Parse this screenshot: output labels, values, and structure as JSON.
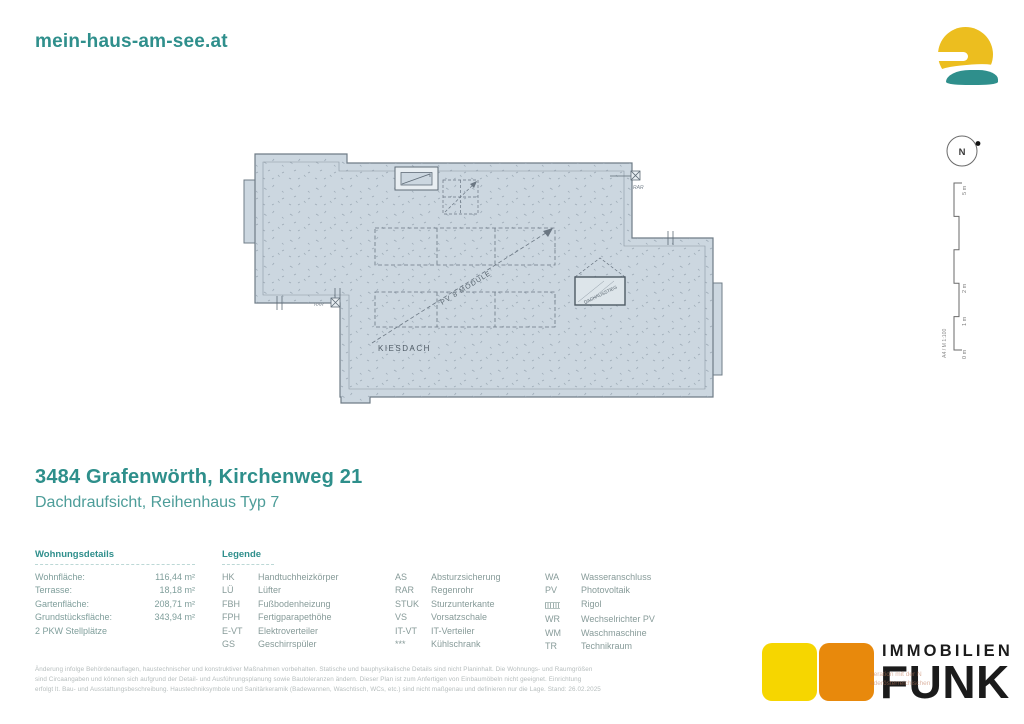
{
  "header": {
    "site_name": "mein-haus-am-see.at"
  },
  "compass": {
    "label": "N"
  },
  "scalebar": {
    "m0": "0 m",
    "m1": "1 m",
    "m2": "2 m",
    "m5": "5 m",
    "note": "A4 / M 1:100"
  },
  "plan": {
    "roof_label": "KIESDACH",
    "pv_label": "PV 8 MODULE",
    "hatch_label": "DACHAUSSTIEG",
    "rar_label_top": "RAR",
    "rar_label_bottom": "RAR"
  },
  "title": {
    "heading": "3484 Grafenwörth, Kirchenweg 21",
    "subheading": "Dachdraufsicht, Reihenhaus Typ 7"
  },
  "details": {
    "header": "Wohnungsdetails",
    "rows": [
      {
        "label": "Wohnfläche:",
        "value": "116,44 m²"
      },
      {
        "label": "Terrasse:",
        "value": "18,18 m²"
      },
      {
        "label": "Gartenfläche:",
        "value": "208,71 m²"
      },
      {
        "label": "Grundstücksfläche:",
        "value": "343,94 m²"
      }
    ],
    "extra": "2 PKW Stellplätze"
  },
  "legend": {
    "header": "Legende",
    "col1": [
      {
        "abbr": "HK",
        "term": "Handtuchheizkörper"
      },
      {
        "abbr": "LÜ",
        "term": "Lüfter"
      },
      {
        "abbr": "FBH",
        "term": "Fußbodenheizung"
      },
      {
        "abbr": "FPH",
        "term": "Fertigparapethöhe"
      },
      {
        "abbr": "E-VT",
        "term": "Elektroverteiler"
      },
      {
        "abbr": "GS",
        "term": "Geschirrspüler"
      }
    ],
    "col2": [
      {
        "abbr": "AS",
        "term": "Absturzsicherung"
      },
      {
        "abbr": "RAR",
        "term": "Regenrohr"
      },
      {
        "abbr": "STUK",
        "term": "Sturzunterkante"
      },
      {
        "abbr": "VS",
        "term": "Vorsatzschale"
      },
      {
        "abbr": "IT-VT",
        "term": "IT-Verteiler"
      },
      {
        "abbr": "***",
        "term": "Kühlschrank"
      }
    ],
    "col3": [
      {
        "abbr": "WA",
        "term": "Wasseranschluss"
      },
      {
        "abbr": "PV",
        "term": "Photovoltaik"
      },
      {
        "abbr": "",
        "term": "Rigol"
      },
      {
        "abbr": "WR",
        "term": "Wechselrichter PV"
      },
      {
        "abbr": "WM",
        "term": "Waschmaschine"
      },
      {
        "abbr": "TR",
        "term": "Technikraum"
      }
    ]
  },
  "disclaimer": {
    "line1": "Änderung infolge Behördenauflagen, haustechnischer und konstruktiver Maßnahmen vorbehalten. Statische und bauphysikalische Details sind nicht Planinhalt. Die Wohnungs- und Raumgrößen",
    "line2": "sind Circaangaben und können sich aufgrund der Detail- und Ausführungsplanung sowie Bautoleranzen ändern. Dieser Plan ist zum Anfertigen von Einbaumöbeln nicht geeignet. Einrichtung",
    "line3": "erfolgt lt. Bau- und Ausstattungsbeschreibung. Haustechniksymbole und Sanitärkeramik (Badewannen, Waschtisch, WCs, etc.) sind nicht maßgenau und definieren nur die Lage. Stand: 26.02.2025"
  },
  "funk": {
    "brand_top": "IMMOBILIEN",
    "brand_main": "FUNK",
    "watermark_line1": "peration mit der N",
    "watermark_line2": "ederösterreichischen"
  }
}
